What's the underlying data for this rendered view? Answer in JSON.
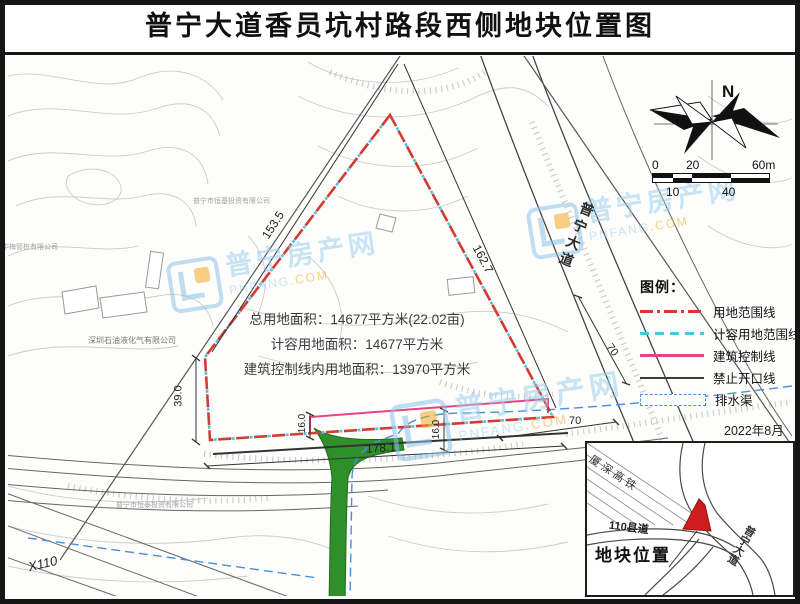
{
  "title": "普宁大道香员坑村路段西侧地块位置图",
  "compass": {
    "north": "N"
  },
  "scale_bar": {
    "l0": "0",
    "l20": "20",
    "l60": "60m",
    "l10": "10",
    "l40": "40"
  },
  "legend": {
    "heading": "图例：",
    "items": [
      {
        "label": "用地范围线",
        "style": "red-dash-dot",
        "color": "#d23b32"
      },
      {
        "label": "计容用地范围线",
        "style": "cyan-dash",
        "color": "#45c8e2"
      },
      {
        "label": "建筑控制线",
        "style": "pink-solid",
        "color": "#e8437e"
      },
      {
        "label": "禁止开口线",
        "style": "dark-solid",
        "color": "#3a3a3a"
      },
      {
        "label": "排水渠",
        "style": "blue-dash-rect",
        "color": "#4a90d9"
      }
    ]
  },
  "date": "2022年8月",
  "site_info": {
    "line1": "总用地面积：14677平方米(22.02亩)",
    "line2": "计容用地面积：14677平方米",
    "line3": "建筑控制线内用地面积：13970平方米"
  },
  "dimensions": {
    "d1": "153.5",
    "d2": "162.7",
    "d3": "39.0",
    "d4": "178.1",
    "d5": "16.0",
    "d6": "16.0",
    "d7": "70",
    "d8": "70"
  },
  "roads": {
    "main_avenue": "普宁大道",
    "county_road": "X110"
  },
  "companies": {
    "c1": "中梅管桩有限公司",
    "c2": "深圳石油液化气有限公司",
    "c3": "普宁市恒基投资有限公司",
    "c4": "普宁市恒泰投资有限公司"
  },
  "watermark": {
    "cn": "普宁房产网",
    "en_name": "PNFANG",
    "en_tld": ".COM"
  },
  "inset": {
    "title": "地块位置",
    "rail": "厦深高铁",
    "county_road": "110县道",
    "avenue": "普宁大道"
  },
  "colors": {
    "boundary_red": "#d23b32",
    "capacity_cyan": "#45c8e2",
    "control_pink": "#e8437e",
    "no_open_dark": "#3a3a3a",
    "drain_blue": "#4a90d9",
    "green_area": "#2f8f2a",
    "inset_plot_red": "#cf1d1d"
  }
}
